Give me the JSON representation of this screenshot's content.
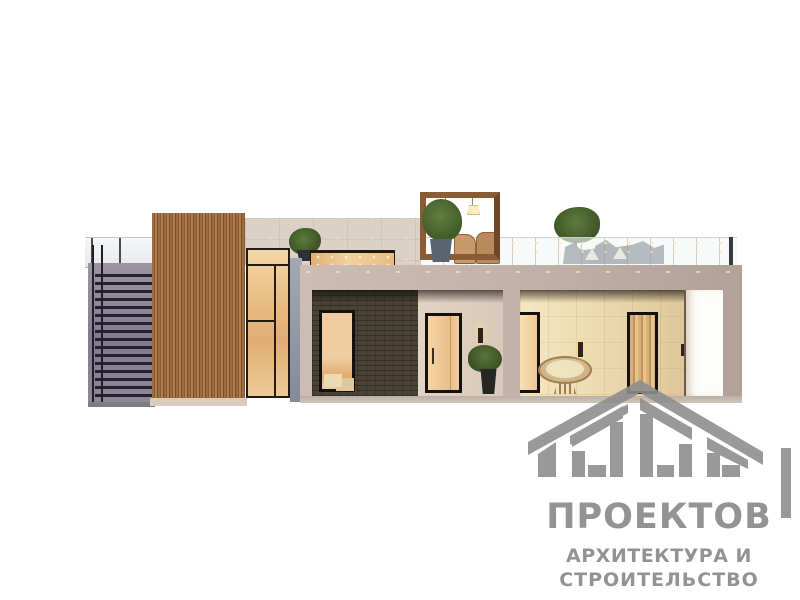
{
  "watermark": {
    "logo_number": "1000",
    "brand_name": "ПРОЕКТОВ",
    "tagline_line1": "АРХИТЕКТУРА И",
    "tagline_line2": "СТРОИТЕЛЬСТВО",
    "logo_color": "#8e8e8e"
  },
  "scene_colors": {
    "background": "#ffffff",
    "wood_cladding": "#9d6c3f",
    "upper_wall": "#dbd1c4",
    "lower_wall": "#c2b1a8",
    "dark_brick_wall": "#4a4334",
    "warm_window_glow": "#f0cf9d",
    "window_frame": "#15100b",
    "stair_wall": "#8a8292",
    "glass_railing": "#f4f6f7",
    "lounge_cushions": "#4e5663",
    "foliage": "#4c6a31",
    "pergola_wood": "#8a5c36"
  }
}
